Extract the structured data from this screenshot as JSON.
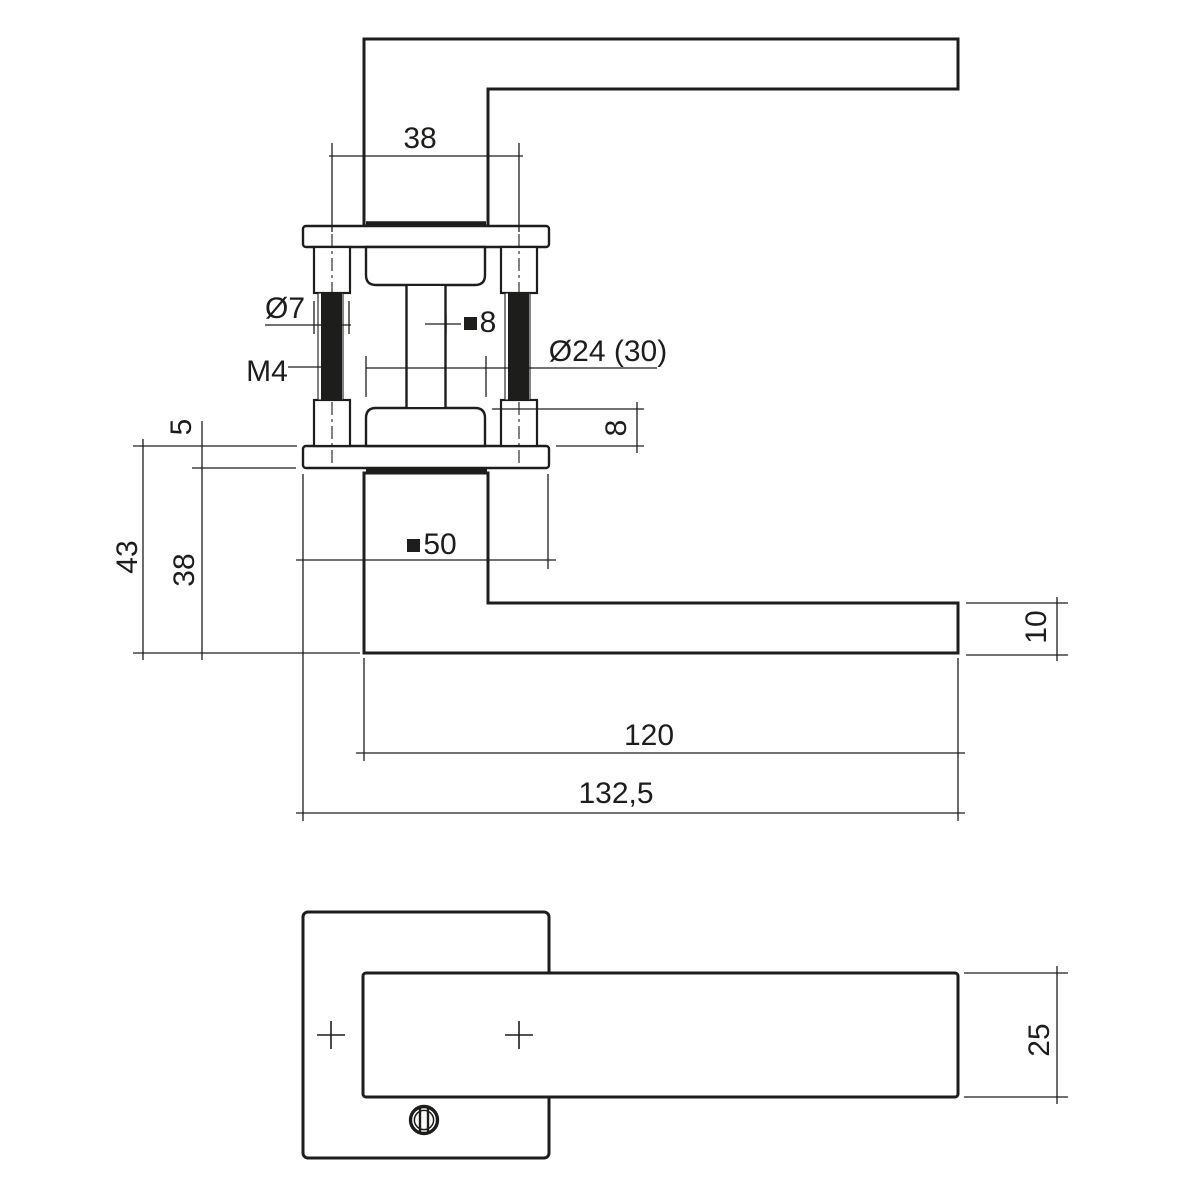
{
  "meta": {
    "drawing_type": "technical dimension drawing of a door lever handle on square rosette",
    "line_color": "#1d1d1b",
    "background_color": "#ffffff"
  },
  "icons": {
    "square_section_symbol": "■",
    "screw_slot_icon": "slotted screw head, front view"
  },
  "labels": {
    "hole_spacing": "38",
    "sleeve_diameter": "Ø7",
    "thread": "M4",
    "spindle_square": "8",
    "neck_diameter": "Ø24 (30)",
    "hub_height": "8",
    "rosette_thickness": "5",
    "total_height": "43",
    "neck_height": "38",
    "lever_thickness": "10",
    "lever_length": "120",
    "total_length": "132,5",
    "rosette_square": "50",
    "lever_width": "25"
  }
}
